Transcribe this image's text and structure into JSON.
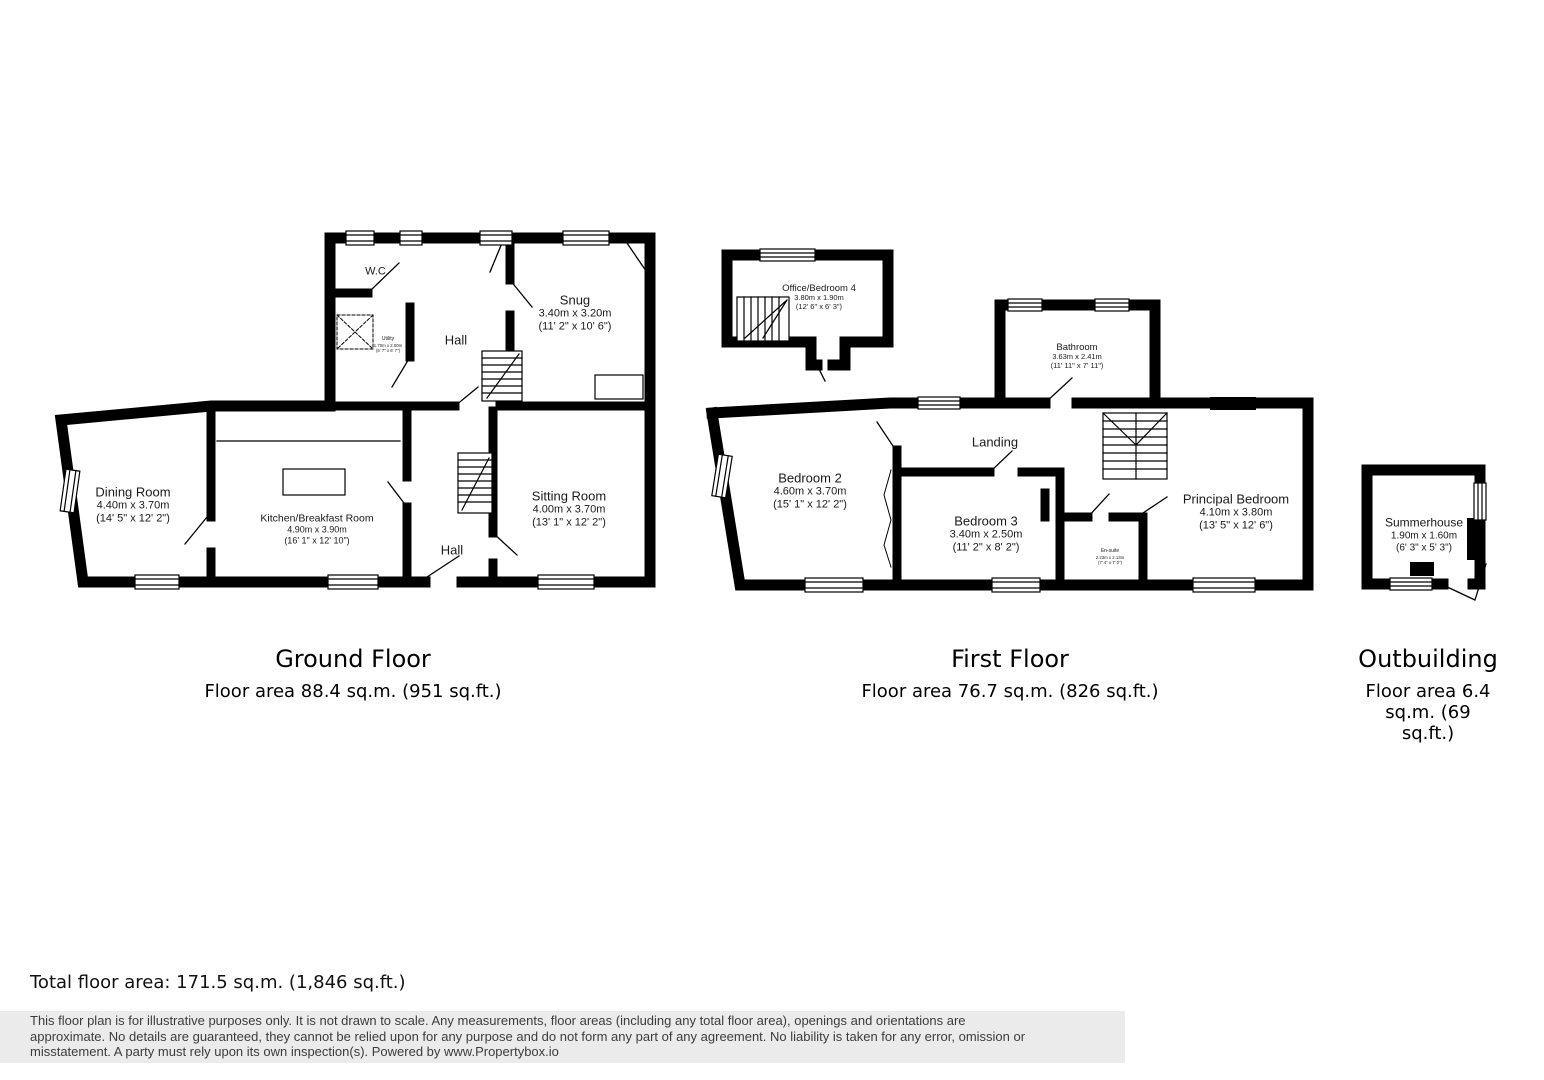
{
  "colors": {
    "wall": "#000000",
    "background": "#ffffff",
    "disclaimer_band": "#ebebeb"
  },
  "floors": {
    "ground": {
      "title": "Ground Floor",
      "area": "Floor area 88.4 sq.m. (951 sq.ft.)",
      "rooms": {
        "wc": {
          "name": "W.C."
        },
        "utility": {
          "name": "Utility",
          "metric": "1.70m x 2.00m",
          "imperial": "(5' 7\" x 6' 7\")"
        },
        "hall_upper": {
          "name": "Hall"
        },
        "snug": {
          "name": "Snug",
          "metric": "3.40m x 3.20m",
          "imperial": "(11' 2\" x 10' 6\")"
        },
        "dining": {
          "name": "Dining Room",
          "metric": "4.40m x 3.70m",
          "imperial": "(14' 5\" x 12' 2\")"
        },
        "kitchen": {
          "name": "Kitchen/Breakfast Room",
          "metric": "4.90m x 3.90m",
          "imperial": "(16' 1\" x 12' 10\")"
        },
        "sitting": {
          "name": "Sitting Room",
          "metric": "4.00m x 3.70m",
          "imperial": "(13' 1\" x 12' 2\")"
        },
        "hall_lower": {
          "name": "Hall"
        }
      }
    },
    "first": {
      "title": "First Floor",
      "area": "Floor area 76.7 sq.m. (826 sq.ft.)",
      "rooms": {
        "office": {
          "name": "Office/Bedroom 4",
          "metric": "3.80m x 1.90m",
          "imperial": "(12' 6\" x 6' 3\")"
        },
        "bathroom": {
          "name": "Bathroom",
          "metric": "3.63m x 2.41m",
          "imperial": "(11' 11\" x 7' 11\")"
        },
        "landing": {
          "name": "Landing"
        },
        "bedroom2": {
          "name": "Bedroom 2",
          "metric": "4.60m x 3.70m",
          "imperial": "(15' 1\" x 12' 2\")"
        },
        "bedroom3": {
          "name": "Bedroom 3",
          "metric": "3.40m x 2.50m",
          "imperial": "(11' 2\" x 8' 2\")"
        },
        "ensuite": {
          "name": "En-suite",
          "metric": "2.23m x 2.13m",
          "imperial": "(7' 4\" x 7' 0\")"
        },
        "principal": {
          "name": "Principal Bedroom",
          "metric": "4.10m x 3.80m",
          "imperial": "(13' 5\" x 12' 6\")"
        }
      }
    },
    "outbuilding": {
      "title": "Outbuilding",
      "area": "Floor area 6.4 sq.m. (69 sq.ft.)",
      "rooms": {
        "summerhouse": {
          "name": "Summerhouse",
          "metric": "1.90m x 1.60m",
          "imperial": "(6' 3\" x 5' 3\")"
        }
      }
    }
  },
  "total": "Total floor area: 171.5 sq.m. (1,846 sq.ft.)",
  "disclaimer": {
    "line1": "This floor plan is for illustrative purposes only. It is not drawn to scale. Any measurements, floor areas (including any total floor area), openings and orientations are",
    "line2": "approximate. No details are guaranteed, they cannot be relied upon for any purpose and do not form any part of any agreement. No liability is taken for any error, omission or",
    "line3": "misstatement. A party must rely upon its own inspection(s). Powered by www.Propertybox.io"
  }
}
